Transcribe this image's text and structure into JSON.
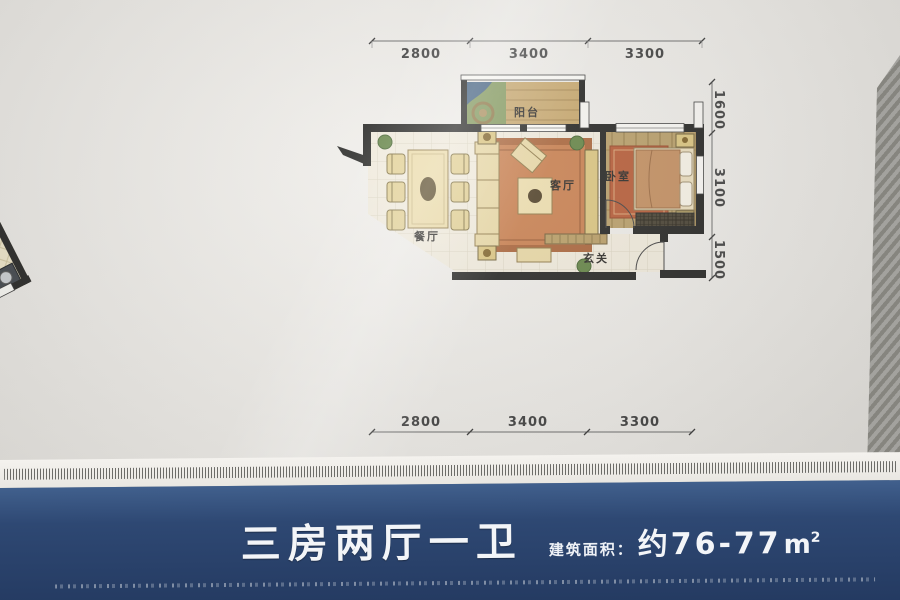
{
  "plan": {
    "labels": {
      "balcony": "阳台",
      "living": "客厅",
      "dining": "餐厅",
      "entry": "玄关",
      "bedroom_right": "卧室",
      "bedroom_upper": "卧室",
      "bedroom_lower": "卧室",
      "bathroom": "卫生间",
      "kitchen": "厨房",
      "duct": "YD"
    },
    "dimensions": {
      "top": [
        "2800",
        "3400",
        "3300"
      ],
      "right": [
        "1600",
        "3100",
        "1500"
      ],
      "bottom": [
        "2800",
        "3400",
        "3300"
      ],
      "wing_top": "3100",
      "wing_left": [
        "3700",
        "3450"
      ],
      "wing_bottom": "3100"
    }
  },
  "footer": {
    "title": "三房两厅一卫",
    "area_label": "建筑面积：",
    "area_value": "约76-77",
    "area_unit": "m",
    "area_exponent": "2"
  },
  "colors": {
    "footer_blue": "#2e4873",
    "paper": "#edebe7",
    "wall": "#1d1d1b",
    "wood_floor": "#b59559",
    "tile_floor": "#efe9da",
    "rug_terracotta": "#c67a48",
    "bath_tile": "#72818d"
  }
}
